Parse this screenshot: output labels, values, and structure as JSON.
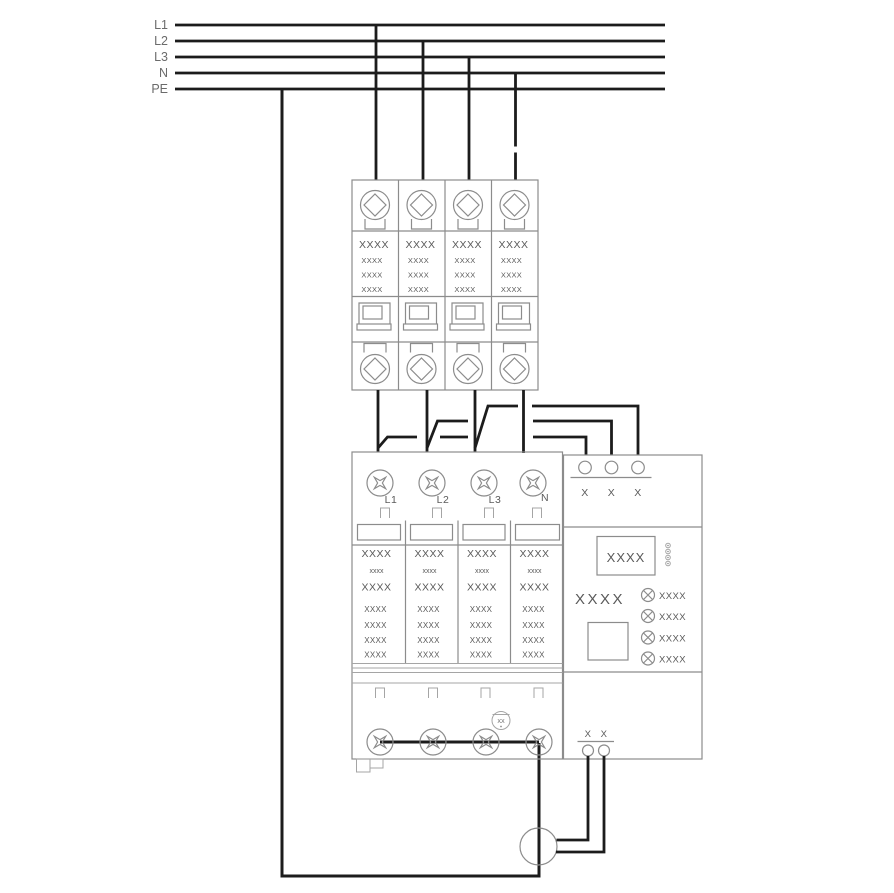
{
  "bus": {
    "labels": [
      "L1",
      "L2",
      "L3",
      "N",
      "PE"
    ]
  },
  "breaker": {
    "poles": [
      {
        "rows": [
          "XXXX",
          "XXXX",
          "XXXX",
          "XXXX"
        ]
      },
      {
        "rows": [
          "XXXX",
          "XXXX",
          "XXXX",
          "XXXX"
        ]
      },
      {
        "rows": [
          "XXXX",
          "XXXX",
          "XXXX",
          "XXXX"
        ]
      },
      {
        "rows": [
          "XXXX",
          "XXXX",
          "XXXX",
          "XXXX"
        ]
      }
    ]
  },
  "spd": {
    "terminal_labels": [
      "L1",
      "L2",
      "L3",
      "N"
    ],
    "modules": [
      {
        "rows": [
          "XXXX",
          "xxxx",
          "XXXX",
          "XXXX",
          "XXXX",
          "XXXX",
          "XXXX"
        ]
      },
      {
        "rows": [
          "XXXX",
          "xxxx",
          "XXXX",
          "XXXX",
          "XXXX",
          "XXXX",
          "XXXX"
        ]
      },
      {
        "rows": [
          "XXXX",
          "xxxx",
          "XXXX",
          "XXXX",
          "XXXX",
          "XXXX",
          "XXXX"
        ]
      },
      {
        "rows": [
          "XXXX",
          "xxxx",
          "XXXX",
          "XXXX",
          "XXXX",
          "XXXX",
          "XXXX"
        ]
      }
    ],
    "ground_ref": "XX",
    "monitor": {
      "top_terminal_labels": [
        "X",
        "X",
        "X"
      ],
      "display_text": "XXXX",
      "model_text": "XXXX",
      "lamp_labels": [
        "XXXX",
        "XXXX",
        "XXXX",
        "XXXX"
      ],
      "bottom_terminal_labels": [
        "X",
        "X"
      ]
    }
  },
  "colors": {
    "wire": "#1c1c1c",
    "device_outline": "#8c8c8c",
    "text": "#5a5a5a",
    "bus_label": "#6b6b6b",
    "background": "#ffffff"
  }
}
